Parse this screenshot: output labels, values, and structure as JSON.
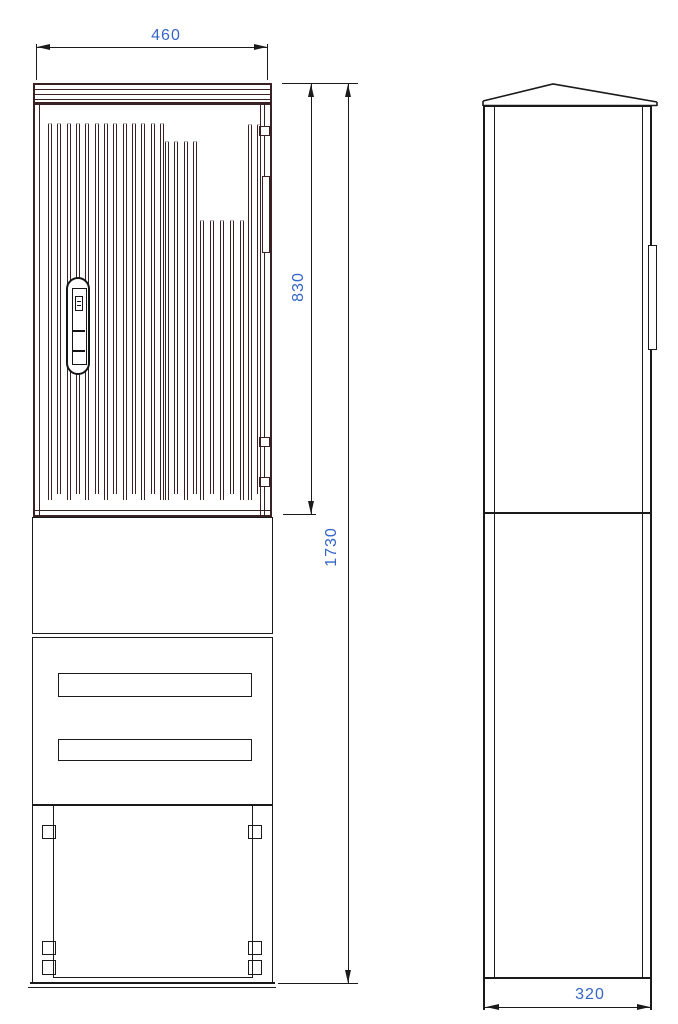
{
  "drawing": {
    "type": "technical-drawing",
    "subject": "cabinet-enclosure-two-views",
    "colors": {
      "door_lines": "#3a2123",
      "body_lines": "#1a1a1a",
      "dimension_text": "#3565c5",
      "background": "#ffffff"
    },
    "views": {
      "front": {
        "label": "front-view",
        "dimensions": {
          "width": {
            "value": "460"
          },
          "door_height": {
            "value": "830"
          },
          "total_height": {
            "value": "1730"
          }
        },
        "rib_groups": [
          {
            "x_start": 48,
            "count": 13,
            "spacing": 9.33,
            "top": 123
          },
          {
            "x_start": 165,
            "count": 4,
            "spacing": 9.33,
            "top": 141
          },
          {
            "x_start": 200,
            "count": 5,
            "spacing": 10.0,
            "top": 220
          },
          {
            "x_start": 248,
            "count": 2,
            "spacing": 9.33,
            "top": 124
          }
        ],
        "rib_bottom": 500,
        "rib_stagger": 6
      },
      "side": {
        "label": "side-view",
        "dimensions": {
          "depth": {
            "value": "320"
          }
        }
      }
    }
  }
}
